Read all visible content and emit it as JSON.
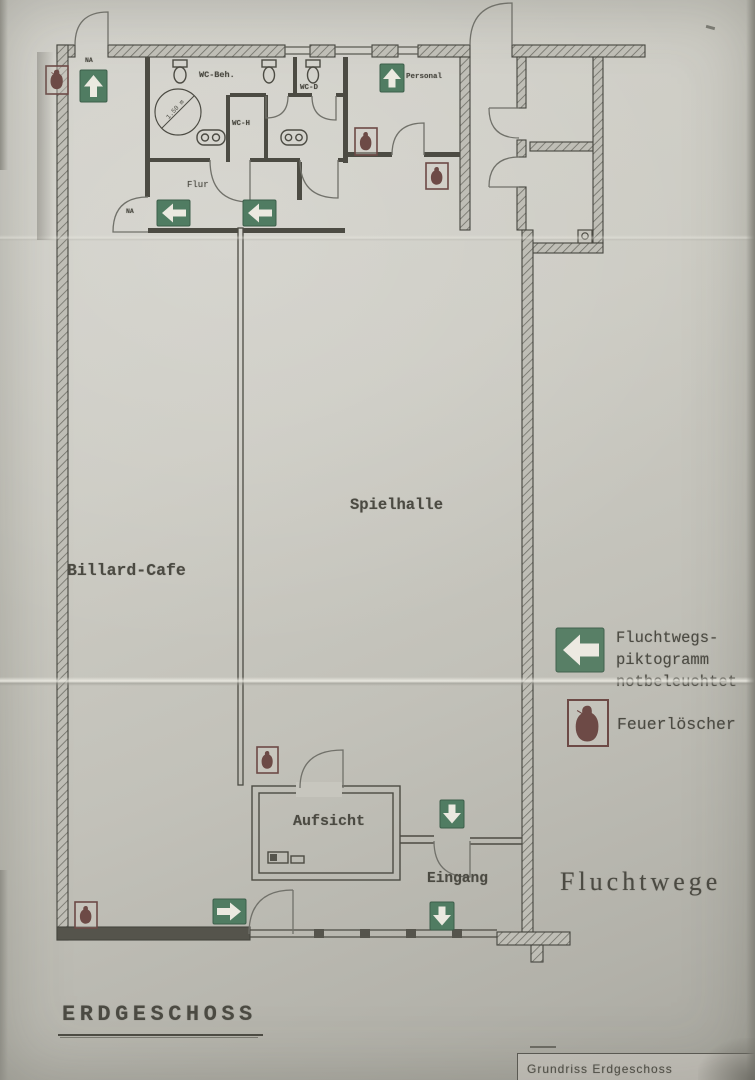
{
  "titles": {
    "plan_type": "Fluchtwege",
    "floor": "ERDGESCHOSS",
    "caption": "Grundriss Erdgeschoss"
  },
  "rooms": {
    "billard_cafe": "Billard-Cafe",
    "spielhalle": "Spielhalle",
    "aufsicht": "Aufsicht",
    "eingang": "Eingang",
    "flur": "Flur",
    "personal": "Personal",
    "wc_beh": "WC-Beh.",
    "wc_h": "WC-H",
    "wc_d": "WC-D",
    "na_top": "NA",
    "na_flur": "NA",
    "turning_circle_dim": "1.50 m"
  },
  "legend": {
    "escape_line1": "Fluchtwegs-",
    "escape_line2": "piktogramm",
    "escape_line3": "notbeleuchtet",
    "extinguisher_label": "Feuerlöscher"
  },
  "palette": {
    "paper": "#cac9c1",
    "ink": "#4b4a42",
    "escape_green": "#507c62",
    "extinguisher_brown": "#6d4a46"
  }
}
